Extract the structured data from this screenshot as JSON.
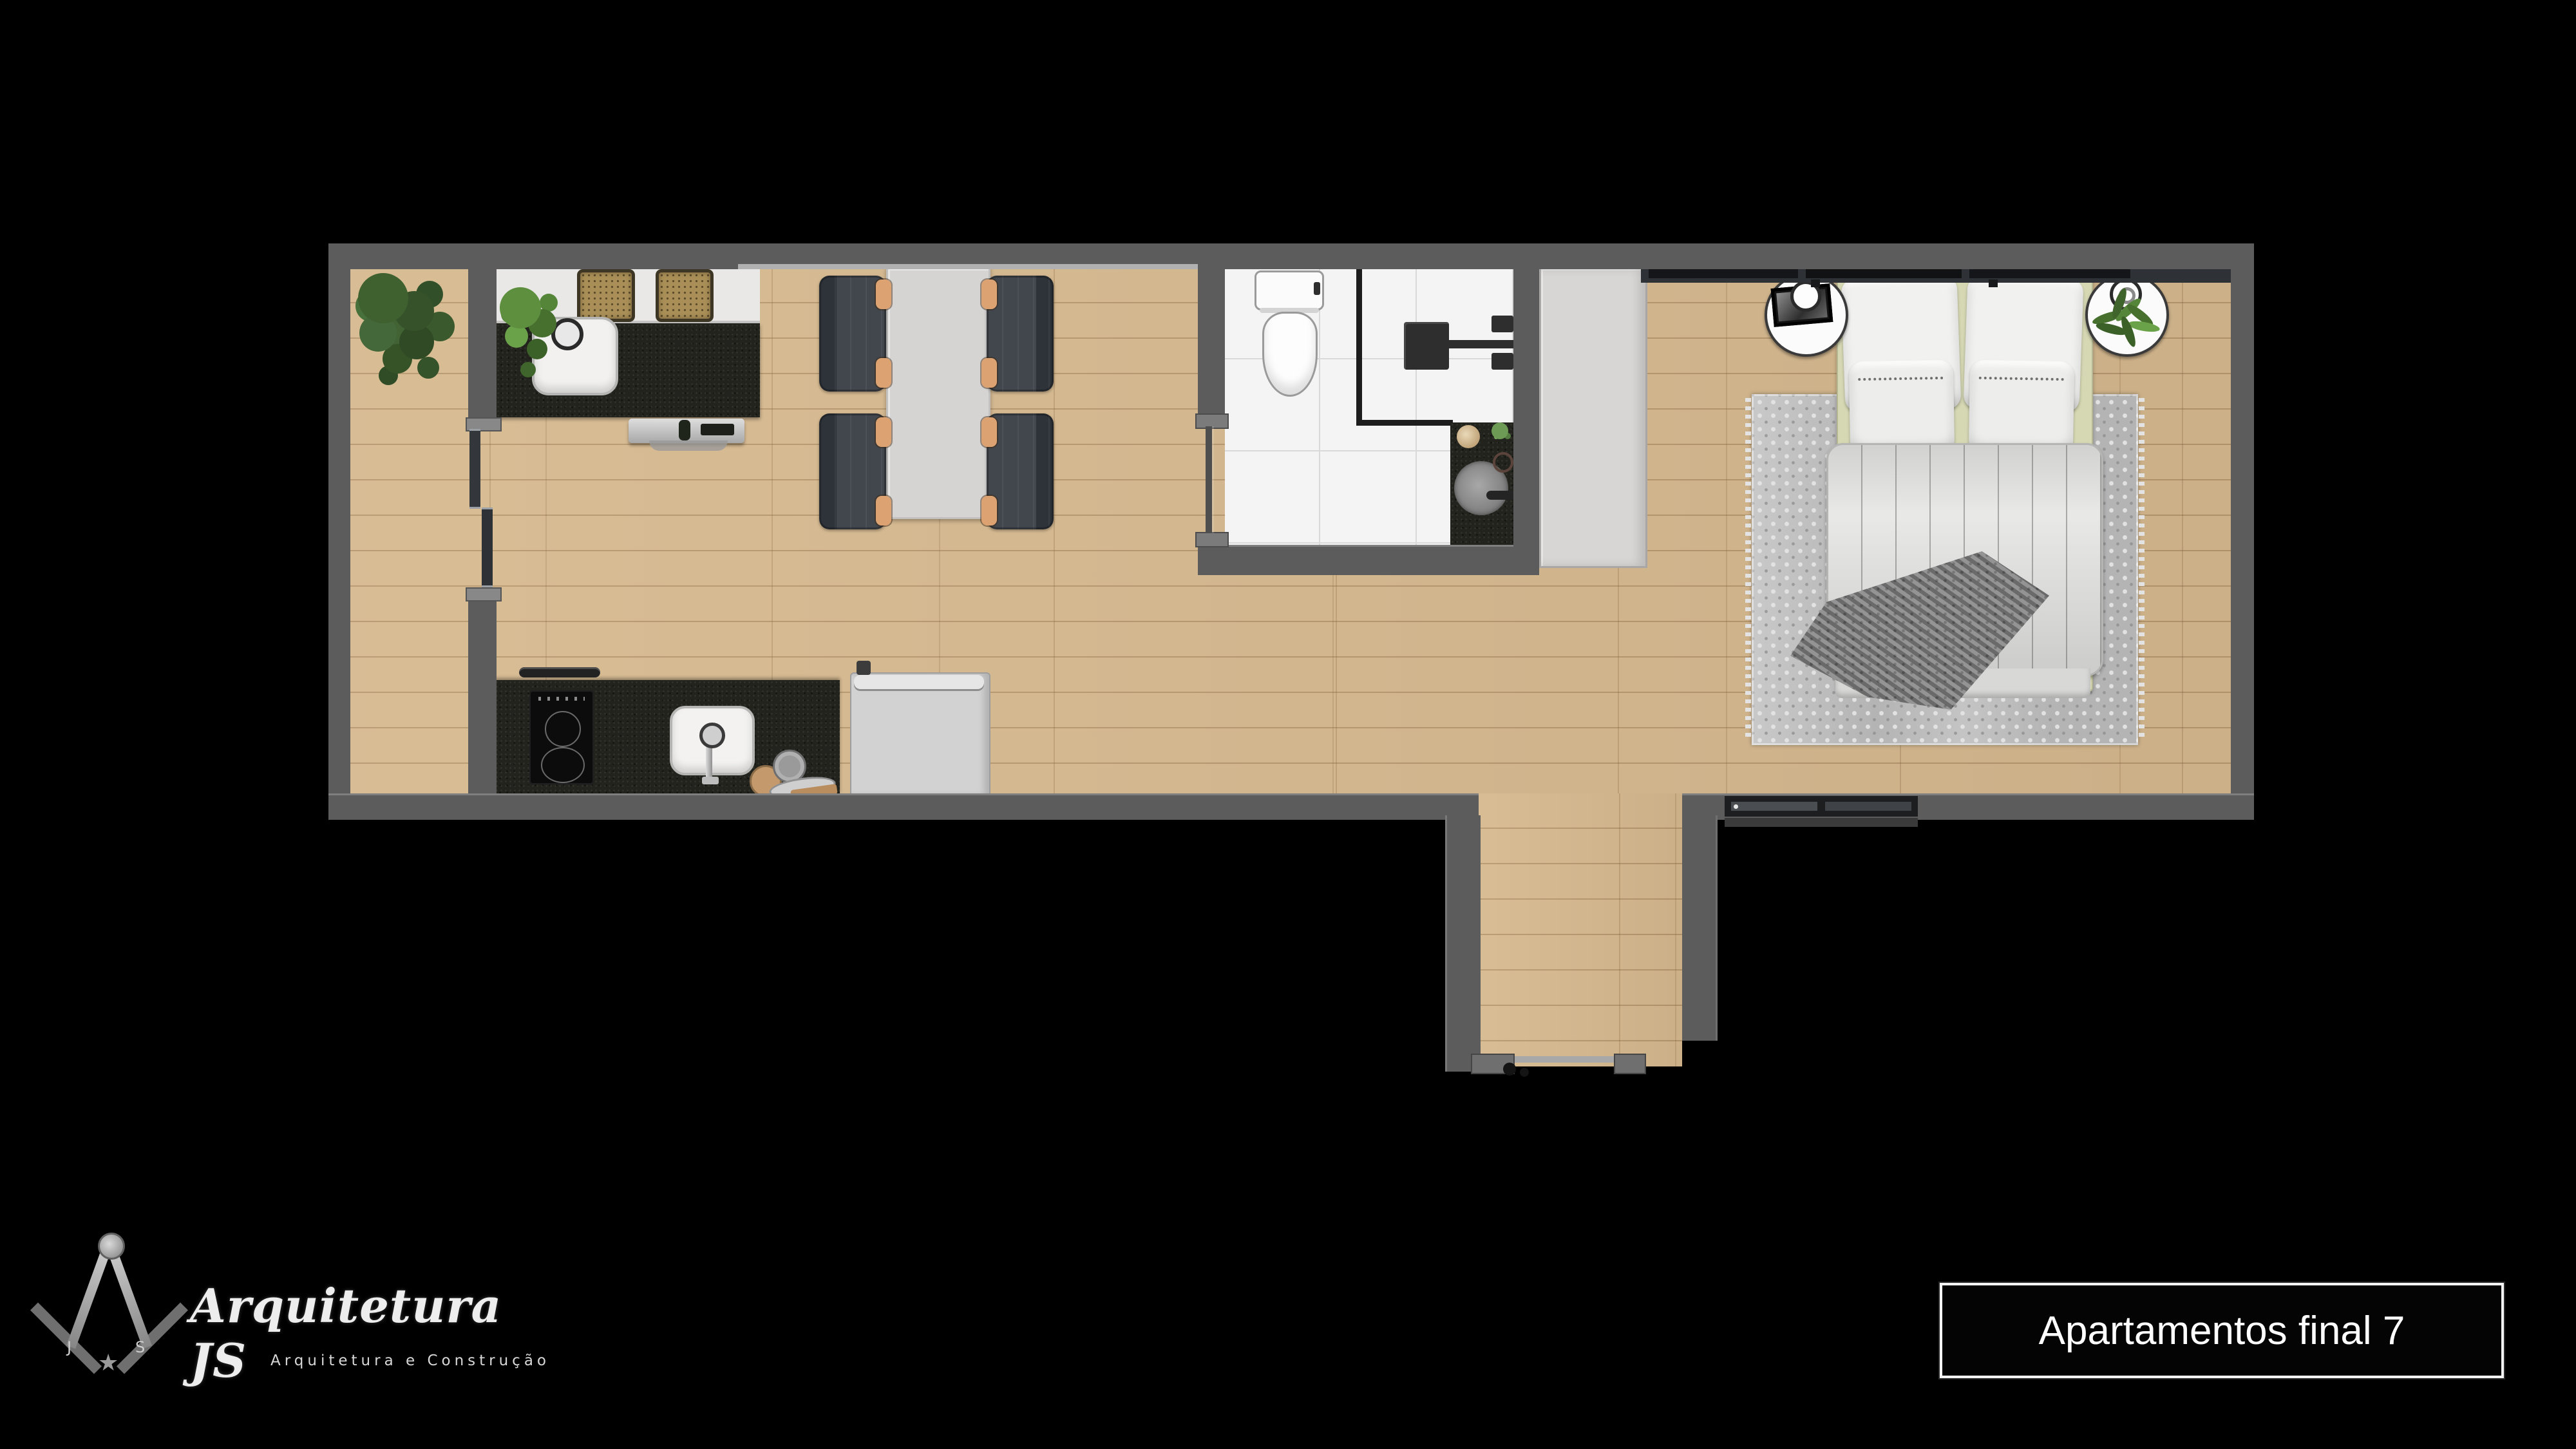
{
  "background": "#000000",
  "branding": {
    "name": "Arquitetura JS",
    "subtitle": "Arquitetura e Construção",
    "monogram_left": "J",
    "monogram_right": "S",
    "star": "★"
  },
  "title_box": {
    "text": "Apartamentos final 7",
    "border_color": "#f5f5f5",
    "text_color": "#ffffff"
  },
  "palette": {
    "wall": "#5c5c5c",
    "wood_floor": "#d6b98f",
    "wood_plank_line": "#b3925f",
    "bathroom_tile": "#f4f4f4",
    "tile_grout": "#d9d9d9",
    "granite_counter": "#23231e",
    "white_counter": "#e9e8e6",
    "dining_table": "#d5d4d2",
    "chair_body": "#41464d",
    "chair_armrest": "#dda272",
    "stool_rattan": "#a98e57",
    "refrigerator": "#d2d2d2",
    "wardrobe": "#d8d6d4",
    "bed_base": "#d6d8b4",
    "duvet": "#e3e3e1",
    "throw_blanket": "#8c8c8c",
    "area_rug": "#b4b4b4",
    "plant_dark_green": "#3d5c2e",
    "plant_light_green": "#5d8f3f",
    "fixture_dark": "#2b2b2b"
  },
  "plan": {
    "rooms": [
      "balcony",
      "kitchen",
      "living-dining",
      "bathroom",
      "entry-corridor",
      "bedroom"
    ],
    "furniture": [
      "balcony-plant",
      "island-counter",
      "bar-stool",
      "island-sink",
      "kitchen-plant",
      "range-hood",
      "cooktop",
      "kitchen-sink",
      "dishware",
      "refrigerator",
      "dining-table",
      "dining-chair",
      "balcony-sliding-door",
      "bathroom-sliding-door",
      "toilet",
      "shower-enclosure",
      "shower-head",
      "bathroom-vanity",
      "vanity-sink",
      "wardrobe",
      "double-bed",
      "pillow",
      "duvet",
      "throw-blanket",
      "area-rug",
      "nightstand",
      "table-lamp",
      "nightstand-plant",
      "picture-frame",
      "bedroom-window",
      "entry-door"
    ]
  }
}
